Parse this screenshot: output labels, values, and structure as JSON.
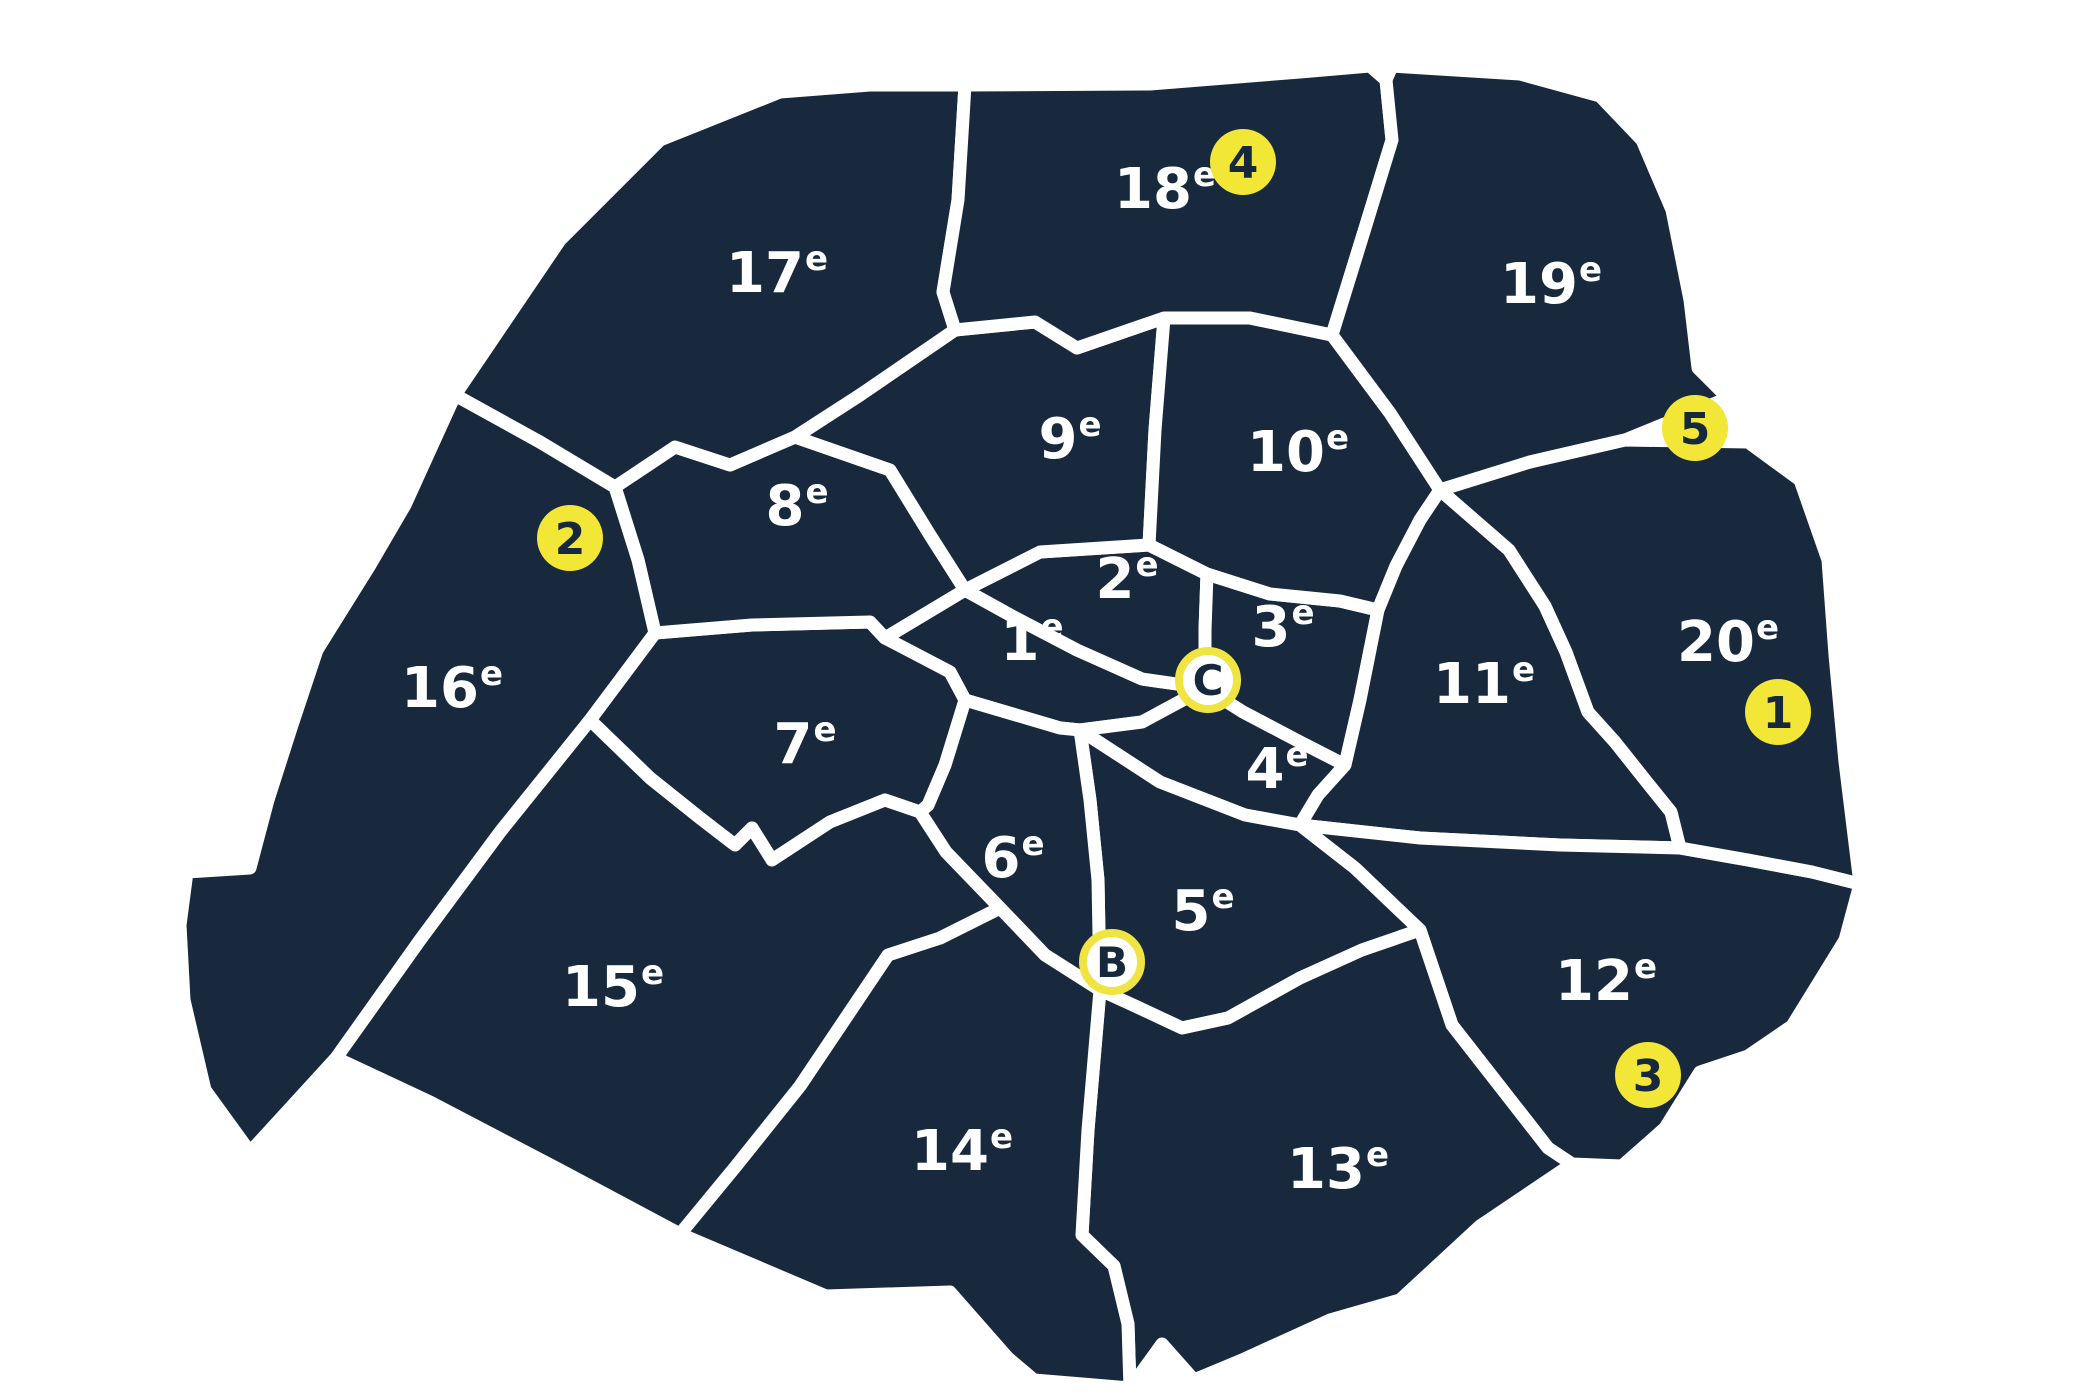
{
  "map": {
    "name": "Paris arrondissements map",
    "colors": {
      "district_fill": "#18293D",
      "border_white": "#FFFFFF",
      "label_text": "#FFFFFF",
      "marker_yellow": "#F2E636",
      "marker_ring_yellow": "#F0E443",
      "marker_letter_fill": "#FFFFFF",
      "marker_text_navy": "#16293C"
    },
    "districts": [
      {
        "id": "1",
        "label": "1",
        "sup": "e",
        "x": 1032,
        "y": 660
      },
      {
        "id": "2",
        "label": "2",
        "sup": "e",
        "x": 1127,
        "y": 598
      },
      {
        "id": "3",
        "label": "3",
        "sup": "e",
        "x": 1283,
        "y": 646
      },
      {
        "id": "4",
        "label": "4",
        "sup": "e",
        "x": 1277,
        "y": 788
      },
      {
        "id": "5",
        "label": "5",
        "sup": "e",
        "x": 1203,
        "y": 930
      },
      {
        "id": "6",
        "label": "6",
        "sup": "e",
        "x": 1013,
        "y": 877
      },
      {
        "id": "7",
        "label": "7",
        "sup": "e",
        "x": 805,
        "y": 763
      },
      {
        "id": "8",
        "label": "8",
        "sup": "e",
        "x": 797,
        "y": 525
      },
      {
        "id": "9",
        "label": "9",
        "sup": "e",
        "x": 1070,
        "y": 458
      },
      {
        "id": "10",
        "label": "10",
        "sup": "e",
        "x": 1298,
        "y": 471
      },
      {
        "id": "11",
        "label": "11",
        "sup": "e",
        "x": 1484,
        "y": 703
      },
      {
        "id": "12",
        "label": "12",
        "sup": "e",
        "x": 1606,
        "y": 1000
      },
      {
        "id": "13",
        "label": "13",
        "sup": "e",
        "x": 1338,
        "y": 1188
      },
      {
        "id": "14",
        "label": "14",
        "sup": "e",
        "x": 962,
        "y": 1170
      },
      {
        "id": "15",
        "label": "15",
        "sup": "e",
        "x": 613,
        "y": 1006
      },
      {
        "id": "16",
        "label": "16",
        "sup": "e",
        "x": 452,
        "y": 707
      },
      {
        "id": "17",
        "label": "17",
        "sup": "e",
        "x": 777,
        "y": 292
      },
      {
        "id": "18",
        "label": "18",
        "sup": "e",
        "x": 1165,
        "y": 208
      },
      {
        "id": "19",
        "label": "19",
        "sup": "e",
        "x": 1551,
        "y": 303
      },
      {
        "id": "20",
        "label": "20",
        "sup": "e",
        "x": 1728,
        "y": 661
      }
    ],
    "numbered_markers": [
      {
        "label": "1",
        "x": 1778,
        "y": 712
      },
      {
        "label": "2",
        "x": 570,
        "y": 538
      },
      {
        "label": "3",
        "x": 1648,
        "y": 1075
      },
      {
        "label": "4",
        "x": 1243,
        "y": 162
      },
      {
        "label": "5",
        "x": 1695,
        "y": 428
      }
    ],
    "lettered_markers": [
      {
        "label": "B",
        "x": 1112,
        "y": 962
      },
      {
        "label": "C",
        "x": 1208,
        "y": 680
      }
    ]
  }
}
